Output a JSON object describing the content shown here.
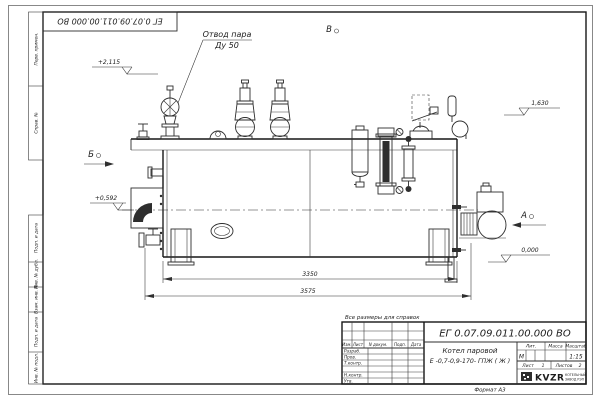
{
  "sheet": {
    "corner_stamp": "ЕГ 0.07.09.011.00.000  ВО",
    "format_label": "Формат А3",
    "border_labels": {
      "top1": "Перв. примен.",
      "top2": "Справ. №",
      "bottom1": "Подп. и дата",
      "bottom2": "Инв. № дубл.",
      "bottom3": "Взам. инв. №",
      "bottom4": "Подп. и дата",
      "bottom5": "Инв. № подл."
    }
  },
  "drawing": {
    "callout_line1": "Отвод пара",
    "callout_line2": "Ду 50",
    "marker_top": "В",
    "marker_left": "Б",
    "marker_right": "А",
    "elev_top": "+2,115",
    "elev_mid_left": "+0,592",
    "elev_right_upper": "1,630",
    "elev_right_lower": "0,000",
    "dim_inner": "3350",
    "dim_outer": "3575"
  },
  "title_block": {
    "note": "Все размеры для справок",
    "doc_number": "ЕГ 0.07.09.011.00.000  ВО",
    "name_line1": "Котел паровой",
    "name_line2": "Е -0,7-0,9-170- ГПЖ ( Ж )",
    "col_izm": "Изм.",
    "col_list": "Лист",
    "col_docum": "N докум.",
    "col_podp": "Подп.",
    "col_data": "Дата",
    "row_razrab": "Разраб.",
    "row_prov": "Пров.",
    "row_tkontr": "Т.контр.",
    "row_nkontr": "Н.контр.",
    "row_utv": "Утв.",
    "lit_header": "Лит.",
    "mass_header": "Масса",
    "scale_header": "Масштаб",
    "lit_value": "М",
    "scale_value": "1:15",
    "sheet_word": "Лист",
    "sheet_num": "1",
    "sheets_word": "Листов",
    "sheets_num": "2",
    "logo_text": "KVZR",
    "logo_sub1": "КОТЕЛЬНЫЙ",
    "logo_sub2": "ЗАВОД РЭП"
  }
}
